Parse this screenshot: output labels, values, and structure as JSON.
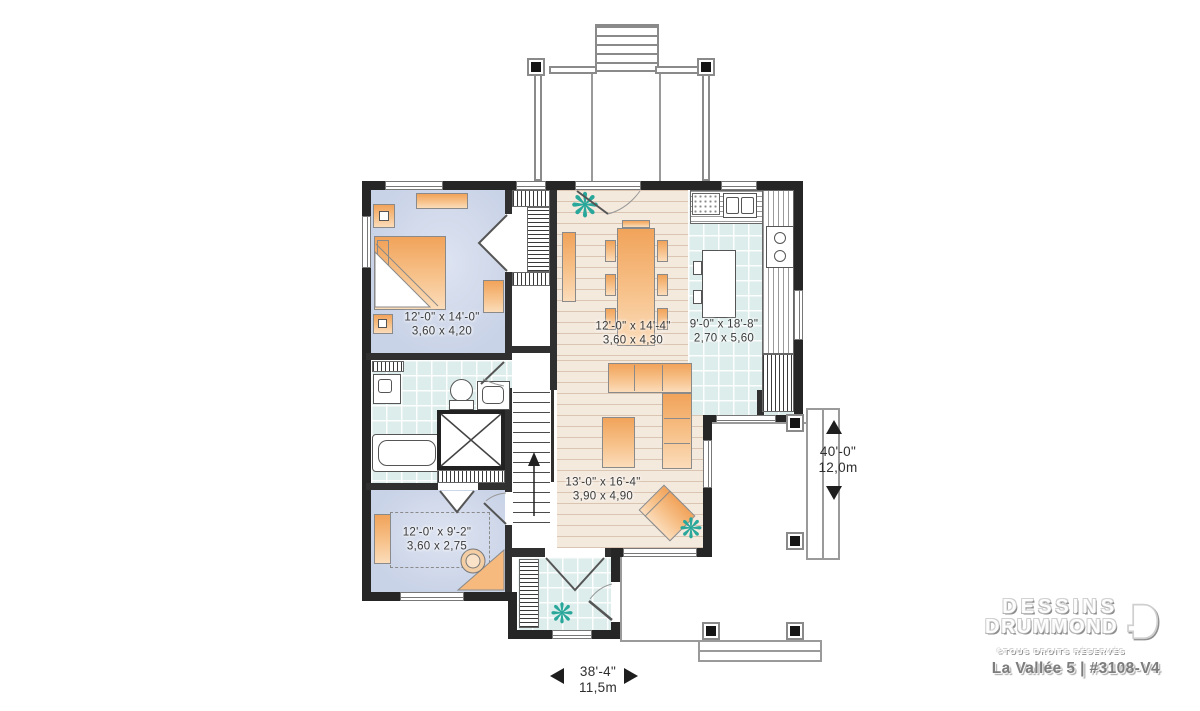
{
  "plan": {
    "rooms": {
      "master_bedroom": {
        "imperial": "12'-0\" x 14'-0\"",
        "metric": "3,60 x 4,20"
      },
      "dining_room": {
        "imperial": "12'-0\" x 14'-4\"",
        "metric": "3,60 x 4,30"
      },
      "kitchen": {
        "imperial": "9'-0\" x 18'-8\"",
        "metric": "2,70 x 5,60"
      },
      "living_room": {
        "imperial": "13'-0\" x 16'-4\"",
        "metric": "3,90 x 4,90"
      },
      "bedroom_2": {
        "imperial": "12'-0\" x 9'-2\"",
        "metric": "3,60 x 2,75"
      }
    },
    "overall_dimensions": {
      "depth": {
        "imperial": "40'-0\"",
        "metric": "12,0m"
      },
      "width": {
        "imperial": "38'-4\"",
        "metric": "11,5m"
      }
    }
  },
  "branding": {
    "company_line1": "DESSINS",
    "company_line2": "DRUMMOND",
    "rights": "©TOUS DROITS RÉSERVÉS",
    "plan_name": "La Vallée 5 | #3108-V4"
  },
  "icons": {
    "plant_icon": "❋"
  },
  "colors": {
    "wall": "#262626",
    "furniture_orange": "#f1a35a",
    "tile_floor": "#dcedeb",
    "wood_floor": "#f4e9dd",
    "carpet_blue": "#c9d3e7",
    "plant_green": "#2aa79b"
  }
}
